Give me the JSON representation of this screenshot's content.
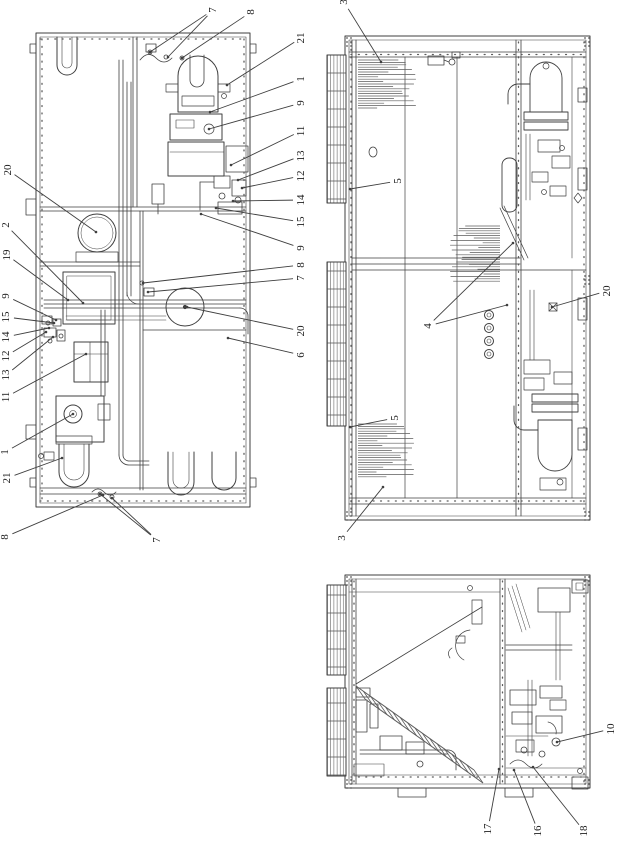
{
  "meta": {
    "description": "Technical patent-style figure page with three orthographic views of a packaged air-conditioning unit, rotated 90 degrees, with numbered part callouts",
    "background": "#ffffff",
    "ink": "#3f3f3f",
    "label_color": "#1d1d1d",
    "label_font_size": 11
  },
  "figures": [
    {
      "id": "fig-a",
      "name": "internal-plan-view",
      "callouts": [
        {
          "label": "7",
          "x": 213,
          "y": 10,
          "targets": [
            [
              150,
              52
            ],
            [
              168,
              57
            ]
          ]
        },
        {
          "label": "8",
          "x": 251,
          "y": 12,
          "targets": [
            [
              182,
              58
            ]
          ]
        },
        {
          "label": "21",
          "x": 301,
          "y": 38,
          "targets": [
            [
              227,
              85
            ]
          ]
        },
        {
          "label": "1",
          "x": 301,
          "y": 79,
          "targets": [
            [
              210,
              112
            ]
          ]
        },
        {
          "label": "9",
          "x": 301,
          "y": 103,
          "targets": [
            [
              209,
              129
            ]
          ]
        },
        {
          "label": "11",
          "x": 301,
          "y": 131,
          "targets": [
            [
              231,
              165
            ]
          ]
        },
        {
          "label": "13",
          "x": 301,
          "y": 156,
          "targets": [
            [
              238,
              180
            ]
          ]
        },
        {
          "label": "12",
          "x": 301,
          "y": 176,
          "targets": [
            [
              242,
              188
            ]
          ]
        },
        {
          "label": "14",
          "x": 301,
          "y": 200,
          "targets": [
            [
              233,
              201
            ]
          ]
        },
        {
          "label": "15",
          "x": 301,
          "y": 222,
          "targets": [
            [
              216,
              208
            ]
          ]
        },
        {
          "label": "9",
          "x": 301,
          "y": 248,
          "targets": [
            [
              201,
              214
            ]
          ]
        },
        {
          "label": "8",
          "x": 301,
          "y": 265,
          "targets": [
            [
              143,
              283
            ]
          ]
        },
        {
          "label": "7",
          "x": 301,
          "y": 278,
          "targets": [
            [
              148,
              292
            ]
          ]
        },
        {
          "label": "20",
          "x": 301,
          "y": 331,
          "targets": [
            [
              187,
              307
            ]
          ]
        },
        {
          "label": "6",
          "x": 301,
          "y": 355,
          "targets": [
            [
              228,
              338
            ]
          ]
        },
        {
          "label": "20",
          "x": 8,
          "y": 170,
          "targets": [
            [
              96,
              232
            ]
          ]
        },
        {
          "label": "2",
          "x": 6,
          "y": 225,
          "targets": [
            [
              83,
              303
            ]
          ]
        },
        {
          "label": "19",
          "x": 7,
          "y": 255,
          "targets": [
            [
              68,
              300
            ]
          ]
        },
        {
          "label": "9",
          "x": 6,
          "y": 296,
          "targets": [
            [
              56,
              320
            ]
          ]
        },
        {
          "label": "15",
          "x": 6,
          "y": 317,
          "targets": [
            [
              54,
              323
            ]
          ]
        },
        {
          "label": "14",
          "x": 6,
          "y": 337,
          "targets": [
            [
              49,
              328
            ]
          ]
        },
        {
          "label": "12",
          "x": 6,
          "y": 356,
          "targets": [
            [
              46,
              332
            ]
          ]
        },
        {
          "label": "13",
          "x": 6,
          "y": 375,
          "targets": [
            [
              53,
              337
            ]
          ]
        },
        {
          "label": "11",
          "x": 6,
          "y": 397,
          "targets": [
            [
              86,
              354
            ]
          ]
        },
        {
          "label": "1",
          "x": 5,
          "y": 452,
          "targets": [
            [
              73,
              414
            ]
          ]
        },
        {
          "label": "21",
          "x": 7,
          "y": 478,
          "targets": [
            [
              62,
              458
            ]
          ]
        },
        {
          "label": "8",
          "x": 5,
          "y": 537,
          "targets": [
            [
              103,
              495
            ]
          ]
        },
        {
          "label": "7",
          "x": 157,
          "y": 540,
          "targets": [
            [
              100,
              494
            ],
            [
              112,
              498
            ]
          ]
        }
      ]
    },
    {
      "id": "fig-b",
      "name": "side-elevation-view",
      "callouts": [
        {
          "label": "3",
          "x": 344,
          "y": 2,
          "targets": [
            [
              381,
              62
            ]
          ]
        },
        {
          "label": "5",
          "x": 398,
          "y": 181,
          "targets": [
            [
              350,
              189
            ]
          ]
        },
        {
          "label": "4",
          "x": 428,
          "y": 326,
          "targets": [
            [
              513,
              243
            ],
            [
              507,
              305
            ]
          ]
        },
        {
          "label": "20",
          "x": 607,
          "y": 291,
          "targets": [
            [
              552,
              307
            ]
          ]
        },
        {
          "label": "5",
          "x": 395,
          "y": 418,
          "targets": [
            [
              350,
              427
            ]
          ]
        },
        {
          "label": "3",
          "x": 342,
          "y": 538,
          "targets": [
            [
              383,
              487
            ]
          ]
        }
      ]
    },
    {
      "id": "fig-c",
      "name": "end-section-view",
      "callouts": [
        {
          "label": "10",
          "x": 611,
          "y": 729,
          "targets": [
            [
              557,
              742
            ]
          ]
        },
        {
          "label": "17",
          "x": 488,
          "y": 829,
          "targets": [
            [
              499,
              769
            ]
          ]
        },
        {
          "label": "16",
          "x": 538,
          "y": 831,
          "targets": [
            [
              514,
              770
            ]
          ]
        },
        {
          "label": "18",
          "x": 584,
          "y": 831,
          "targets": [
            [
              533,
              767
            ]
          ]
        }
      ]
    }
  ]
}
